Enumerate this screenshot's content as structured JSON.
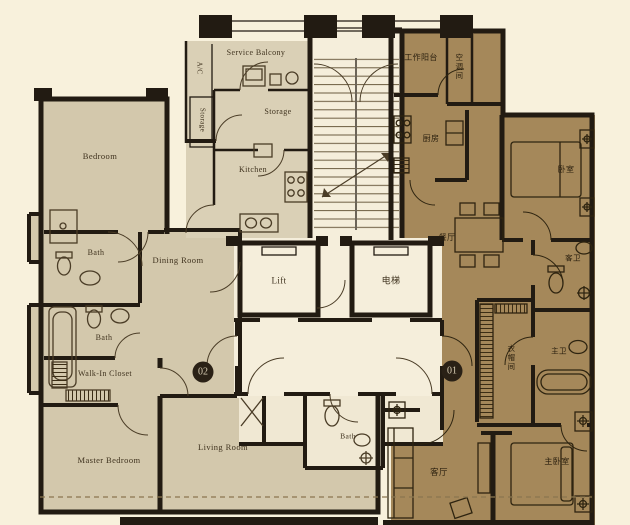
{
  "plan": {
    "badges": {
      "unit02": "02",
      "unit01": "01"
    },
    "core": {
      "lift_en": "Lift",
      "lift_cn": "电梯"
    },
    "unit02_labels": {
      "ac": "A/C",
      "service_balcony": "Service Balcony",
      "storage_closet": "Storage",
      "storage": "Storage",
      "kitchen": "Kitchen",
      "bedroom": "Bedroom",
      "bath_upper": "Bath",
      "dining_room": "Dining Room",
      "bath_lower": "Bath",
      "walk_in_closet": "Walk-In Closet",
      "master_bedroom": "Master Bedroom",
      "living_room": "Living Room",
      "bath_center": "Bath"
    },
    "unit01_labels": {
      "work_balcony": "工作阳台",
      "ac_room": "空调间",
      "kitchen": "厨房",
      "dining": "餐厅",
      "bedroom": "卧室",
      "guest_bath": "客卫",
      "closet": "衣帽间",
      "master_bath": "主卫",
      "living": "客厅",
      "master_bedroom": "主卧室"
    },
    "colors": {
      "background": "#f8f1dc",
      "unit02_floor": "#d3c8ac",
      "service_floor": "#dad0b6",
      "unit01_floor": "#a5885a",
      "core_floor": "#f5eedb",
      "core_floor_dim": "#f0e8d3",
      "wall": "#221b12",
      "fixture02": "#4a3c26",
      "fixture01": "#2e2410",
      "label02": "#3f321e",
      "label01": "#2a1f0e",
      "badge_bg": "#2a2116",
      "badge_text": "#d8cdb4",
      "dashed": "#8a764f"
    }
  }
}
